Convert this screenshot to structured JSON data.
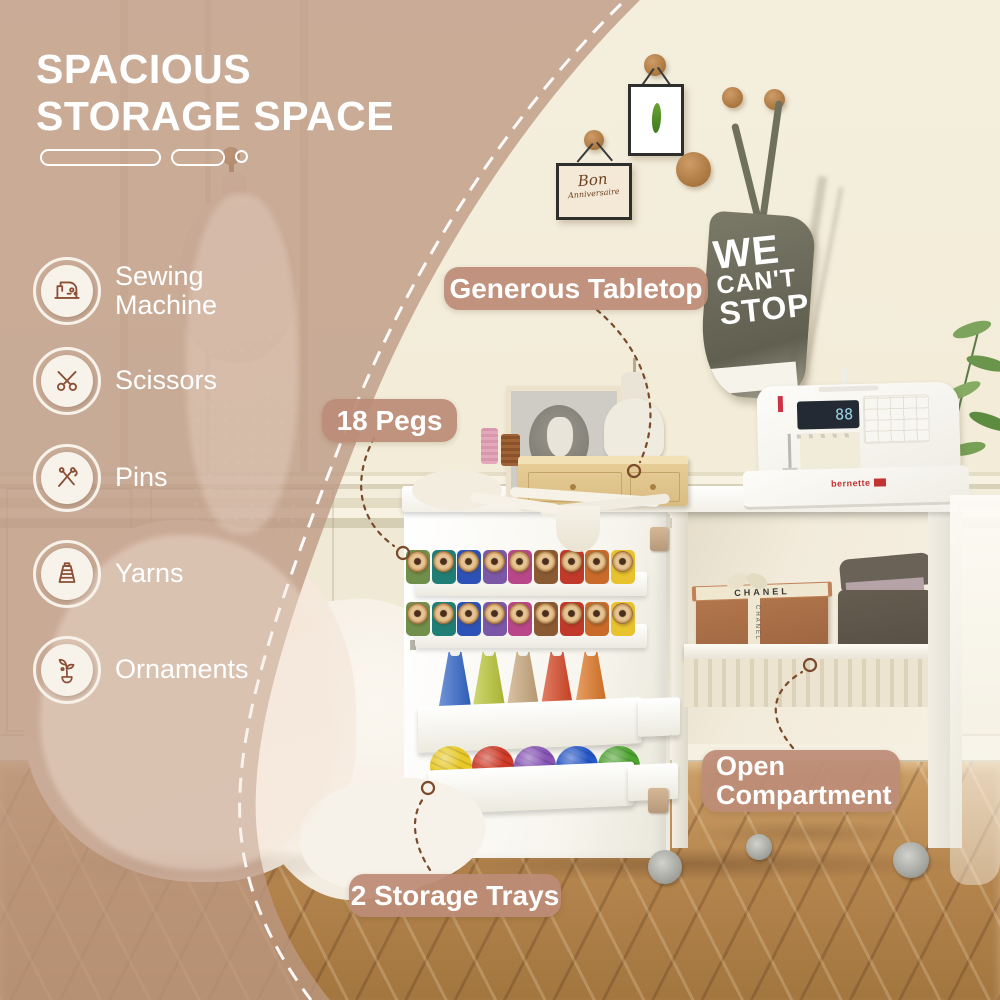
{
  "title": {
    "line1": "SPACIOUS",
    "line2": "STORAGE SPACE"
  },
  "features": [
    {
      "label": "Sewing Machine"
    },
    {
      "label": "Scissors"
    },
    {
      "label": "Pins"
    },
    {
      "label": "Yarns"
    },
    {
      "label": "Ornaments"
    }
  ],
  "callouts": {
    "generous_tabletop": "Generous Tabletop",
    "pegs": "18 Pegs",
    "open_compartment_line1": "Open",
    "open_compartment_line2": "Compartment",
    "storage_trays": "2 Storage Trays"
  },
  "photo": {
    "bag": {
      "line1": "WE",
      "line2": "CAN'T",
      "line3": "STOP"
    },
    "frame_card": {
      "line1": "Bon",
      "line2": "Anniversaire"
    },
    "box_ribbon_text": "CHANEL",
    "machine_brand": "bernette",
    "machine_display": "88",
    "spool_colors": [
      "#6f8f4a",
      "#1f7f76",
      "#2c52b8",
      "#7b57a8",
      "#b8478a",
      "#8a5a33",
      "#c0392b",
      "#c96a2a",
      "#e8c32e"
    ],
    "cone_colors": [
      "#2d62c9",
      "#b9c832",
      "#c9a77a",
      "#d8421f",
      "#e0741f"
    ],
    "yarn_colors": [
      "#e8c928",
      "#d03a28",
      "#8755b5",
      "#2558c8",
      "#4da32f"
    ]
  },
  "colors": {
    "overlay_tan": "#bd9883",
    "badge": "#bc8c76",
    "peg_wood": "#b07c4e",
    "wall_cream": "#f3edda",
    "floor_wood": "#b5854e"
  }
}
